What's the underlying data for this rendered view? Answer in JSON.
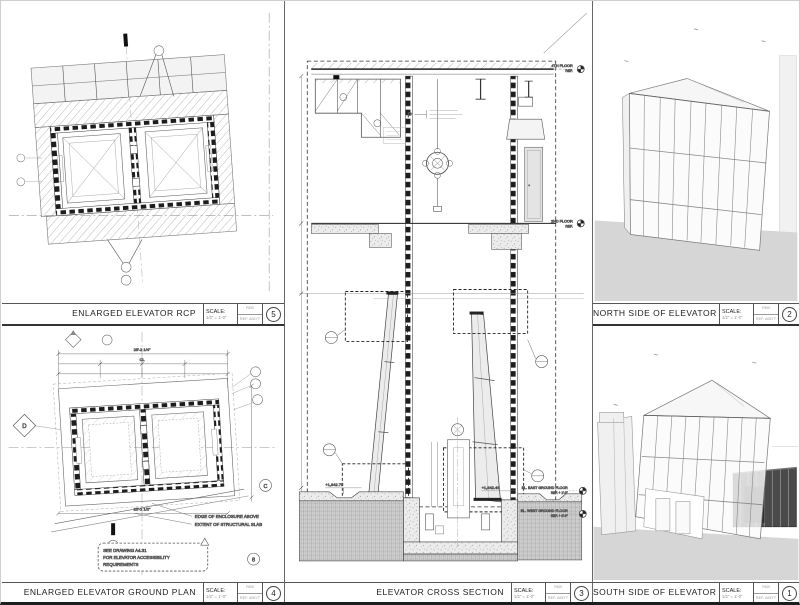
{
  "scale": {
    "label": "SCALE:",
    "value": "1/2\" = 1'-0\"",
    "rev_top": "RKB",
    "rev_bottom": "REF. ADD'T"
  },
  "panels": {
    "rcp": {
      "title": "ENLARGED ELEVATOR RCP",
      "number": "5"
    },
    "ground": {
      "title": "ENLARGED ELEVATOR GROUND PLAN",
      "number": "4",
      "dims": {
        "overall_top": "25'-2 1/4\"",
        "cl": "CL",
        "overall_bottom": "25'-2 1/2\""
      },
      "bubbles": {
        "diamond": "D",
        "circle_c": "C",
        "circle_b": "8"
      },
      "notes": {
        "edge": "EDGE OF ENCLOSURE ABOVE",
        "extent": "EXTENT OF STRUCTURAL SLAB",
        "cloud_1": "SEE DRAWING A4.31",
        "cloud_2": "FOR ELEVATOR ACCESSIBILITY",
        "cloud_3": "REQUIREMENTS"
      }
    },
    "section": {
      "title": "ELEVATOR CROSS SECTION",
      "number": "3",
      "labels": {
        "p_tag": "P",
        "lvl4_1": "4TH FLOOR",
        "lvl4_2": "REF.",
        "lvl2_1": "2ND FLOOR",
        "lvl2_2": "REF.",
        "east_1": "EL. EAST GROUND FLOOR",
        "east_2": "REF. + 1'-0\"",
        "west_1": "EL. WEST GROUND FLOOR",
        "west_2": "REF. + 0'-0\"",
        "pit_el_left": "+1,842.75",
        "pit_el_right": "+1,842.46"
      }
    },
    "north": {
      "title": "NORTH SIDE OF ELEVATOR",
      "number": "2"
    },
    "south": {
      "title": "SOUTH SIDE OF ELEVATOR",
      "number": "1"
    }
  },
  "colors": {
    "ground": "#d6d6d6",
    "glass": "#ececec",
    "dark_storefront": "#4a4a4a",
    "line": "#444444"
  }
}
